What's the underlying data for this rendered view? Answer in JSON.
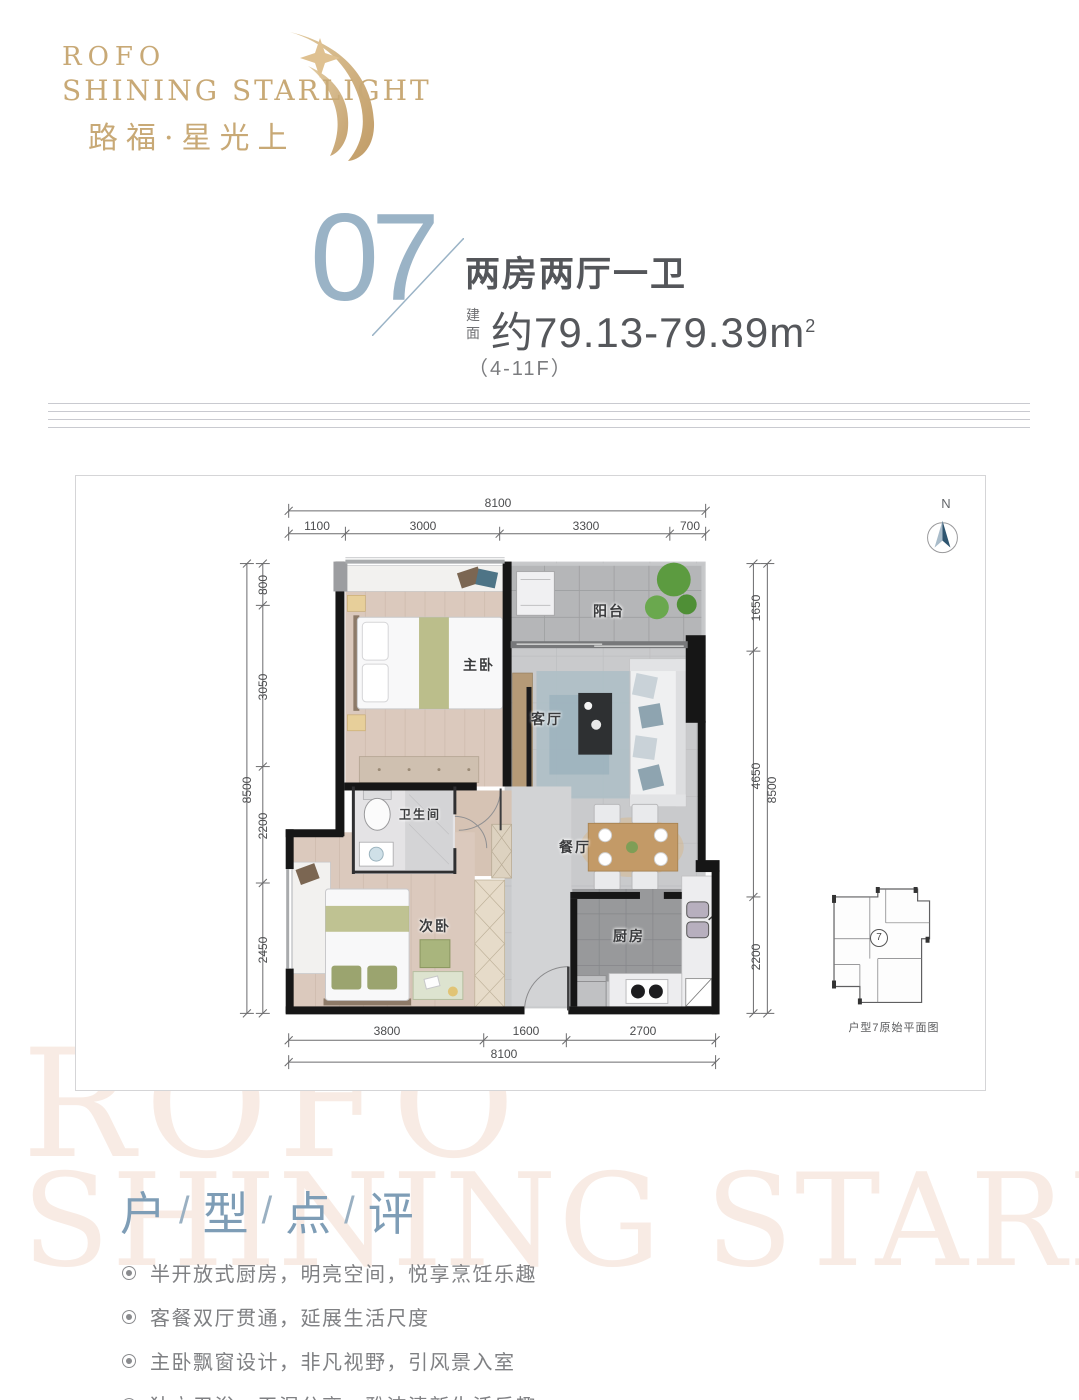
{
  "logo": {
    "en_line1": "ROFO",
    "en_line2": "SHINING STARLIGHT",
    "cn": "路福·星光上"
  },
  "unit": {
    "number": "07",
    "type_label": "两房两厅一卫",
    "area_label": "建面",
    "area_value": "约79.13-79.39m",
    "area_sup": "2",
    "floors": "（4-11F）"
  },
  "plan": {
    "rooms": {
      "balcony": "阳台",
      "master_bedroom": "主卧",
      "living_room": "客厅",
      "bathroom": "卫生间",
      "dining_room": "餐厅",
      "second_bedroom": "次卧",
      "kitchen": "厨房"
    },
    "dims": {
      "top_total": "8100",
      "top": [
        "1100",
        "3000",
        "3300",
        "700"
      ],
      "left_total": "8500",
      "left": [
        "800",
        "3050",
        "2200",
        "2450"
      ],
      "right_total": "8500",
      "right": [
        "1650",
        "4650",
        "2200"
      ],
      "bottom": [
        "3800",
        "1600",
        "2700"
      ],
      "bottom_total": "8100"
    },
    "north": "N",
    "inset": {
      "unit_mark": "7",
      "caption": "户型7原始平面图"
    }
  },
  "review": {
    "title": [
      "户",
      "型",
      "点",
      "评"
    ],
    "separator": "/",
    "bullets": [
      "半开放式厨房，明亮空间，悦享烹饪乐趣",
      "客餐双厅贯通，延展生活尺度",
      "主卧飘窗设计，非凡视野，引风景入室",
      "独立卫浴，干湿分离，雅洁清新生活乐趣"
    ]
  },
  "watermark": {
    "line1": "ROFO",
    "line2": "SHINING STARLIGHT"
  },
  "colors": {
    "gold": "#c8a976",
    "unit_blue": "#9ab3c6",
    "title_blue": "#7e9db6",
    "text_dark": "#55575a",
    "text_gray": "#7f8083",
    "watermark": "#f8ebe4",
    "north_arrow": "#2e5570"
  }
}
